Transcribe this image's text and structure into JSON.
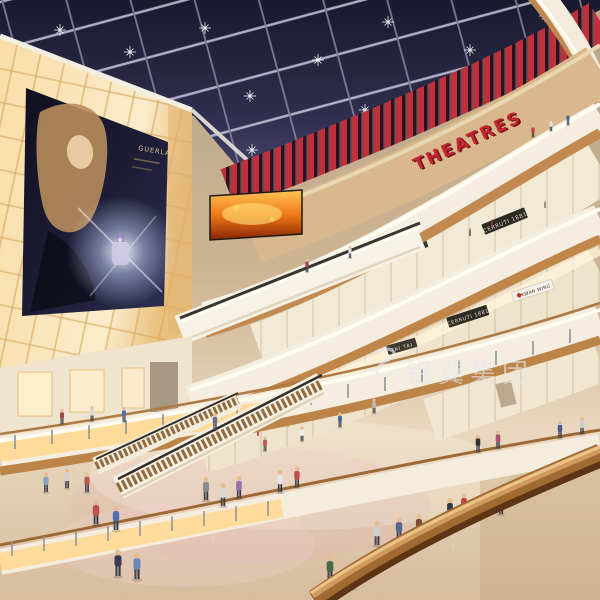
{
  "scene": {
    "type": "architectural rendering photo",
    "subject": "Multi-level shopping mall atrium interior with skylight, escalators, glowing billboard wall and shoppers"
  },
  "signs": {
    "theatres": "THEATRES",
    "billboard_brand": "GUERLAIN",
    "shop_tai_tai": "TAI TAI",
    "shop_cerruti": "CERRUTI 1881",
    "shop_kwan_wing": "KWAN WING"
  },
  "watermark": {
    "text": "铝翼集团"
  },
  "palette": {
    "skylight_navy": "#232338",
    "theatres_red": "#c2252e",
    "slat_red": "#c0303a",
    "warm_glow": "#ffd993",
    "fascia_cream": "#f5eee0",
    "wood_band": "#c28a50",
    "floor_beige": "#e2cfb4",
    "fire_screen_orange": "#ff8c1a",
    "watermark_white": "#e8e8ee"
  }
}
